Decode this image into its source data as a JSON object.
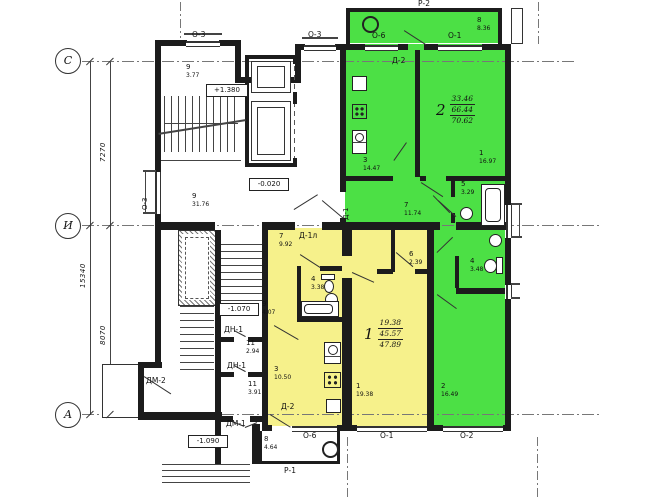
{
  "colors": {
    "apt1_fill": "#f6f18b",
    "apt2_fill": "#4ce045",
    "wall": "#1c1c1c"
  },
  "axis_rows": {
    "c": "С",
    "i": "И",
    "a": "А"
  },
  "dimensions": {
    "d7270": "7270",
    "d8070": "8070",
    "d15340": "15340"
  },
  "elevations": {
    "stair": "+1.380",
    "lobby": "-0.020",
    "mid": "-1.070",
    "entry": "-1.090"
  },
  "labels": {
    "p2": "Р-2",
    "p1": "Р-1",
    "o3": "О-3",
    "o6": "О-6",
    "o1": "О-1",
    "o2": "О-2",
    "d2": "Д-2",
    "d1l": "Д-1л",
    "d1": "Д-1",
    "dn1": "ДН-1",
    "dm1": "ДМ-1",
    "dm2": "ДМ-2"
  },
  "apartment1": {
    "number": "1",
    "area_living": "19.38",
    "area_total": "45.57",
    "area_full": "47.89",
    "rooms": {
      "hall": {
        "num": "7",
        "area": "9.92"
      },
      "closet": {
        "num": "6",
        "area": "2.39"
      },
      "bath": {
        "num": "4",
        "area": "3.38"
      },
      "living": {
        "num": "1",
        "area": "19.38"
      },
      "kitchen": {
        "num": "3",
        "area": "10.50"
      },
      "balcony": {
        "num": "8",
        "area": "4.64"
      }
    }
  },
  "apartment2": {
    "number": "2",
    "area_living": "33.46",
    "area_total": "66.44",
    "area_full": "70.62",
    "rooms": {
      "balcony": {
        "num": "8",
        "area": "8.36"
      },
      "kitchen": {
        "num": "3",
        "area": "14.47"
      },
      "living": {
        "num": "1",
        "area": "16.97"
      },
      "bath": {
        "num": "5",
        "area": "3.29"
      },
      "hall": {
        "num": "7",
        "area": "11.74"
      },
      "wc": {
        "num": "4",
        "area": "3.48"
      },
      "bedroom": {
        "num": "2",
        "area": "16.49"
      }
    }
  },
  "common_rooms": {
    "stair_top": {
      "num": "9",
      "area": "3.77"
    },
    "corridor": {
      "num": "9",
      "area": "31.76"
    },
    "stair_mid": {
      "num": "9",
      "area": "4.07"
    },
    "vestibule1": {
      "num": "11",
      "area": "2.94"
    },
    "vestibule2": {
      "num": "11",
      "area": "3.91"
    }
  }
}
